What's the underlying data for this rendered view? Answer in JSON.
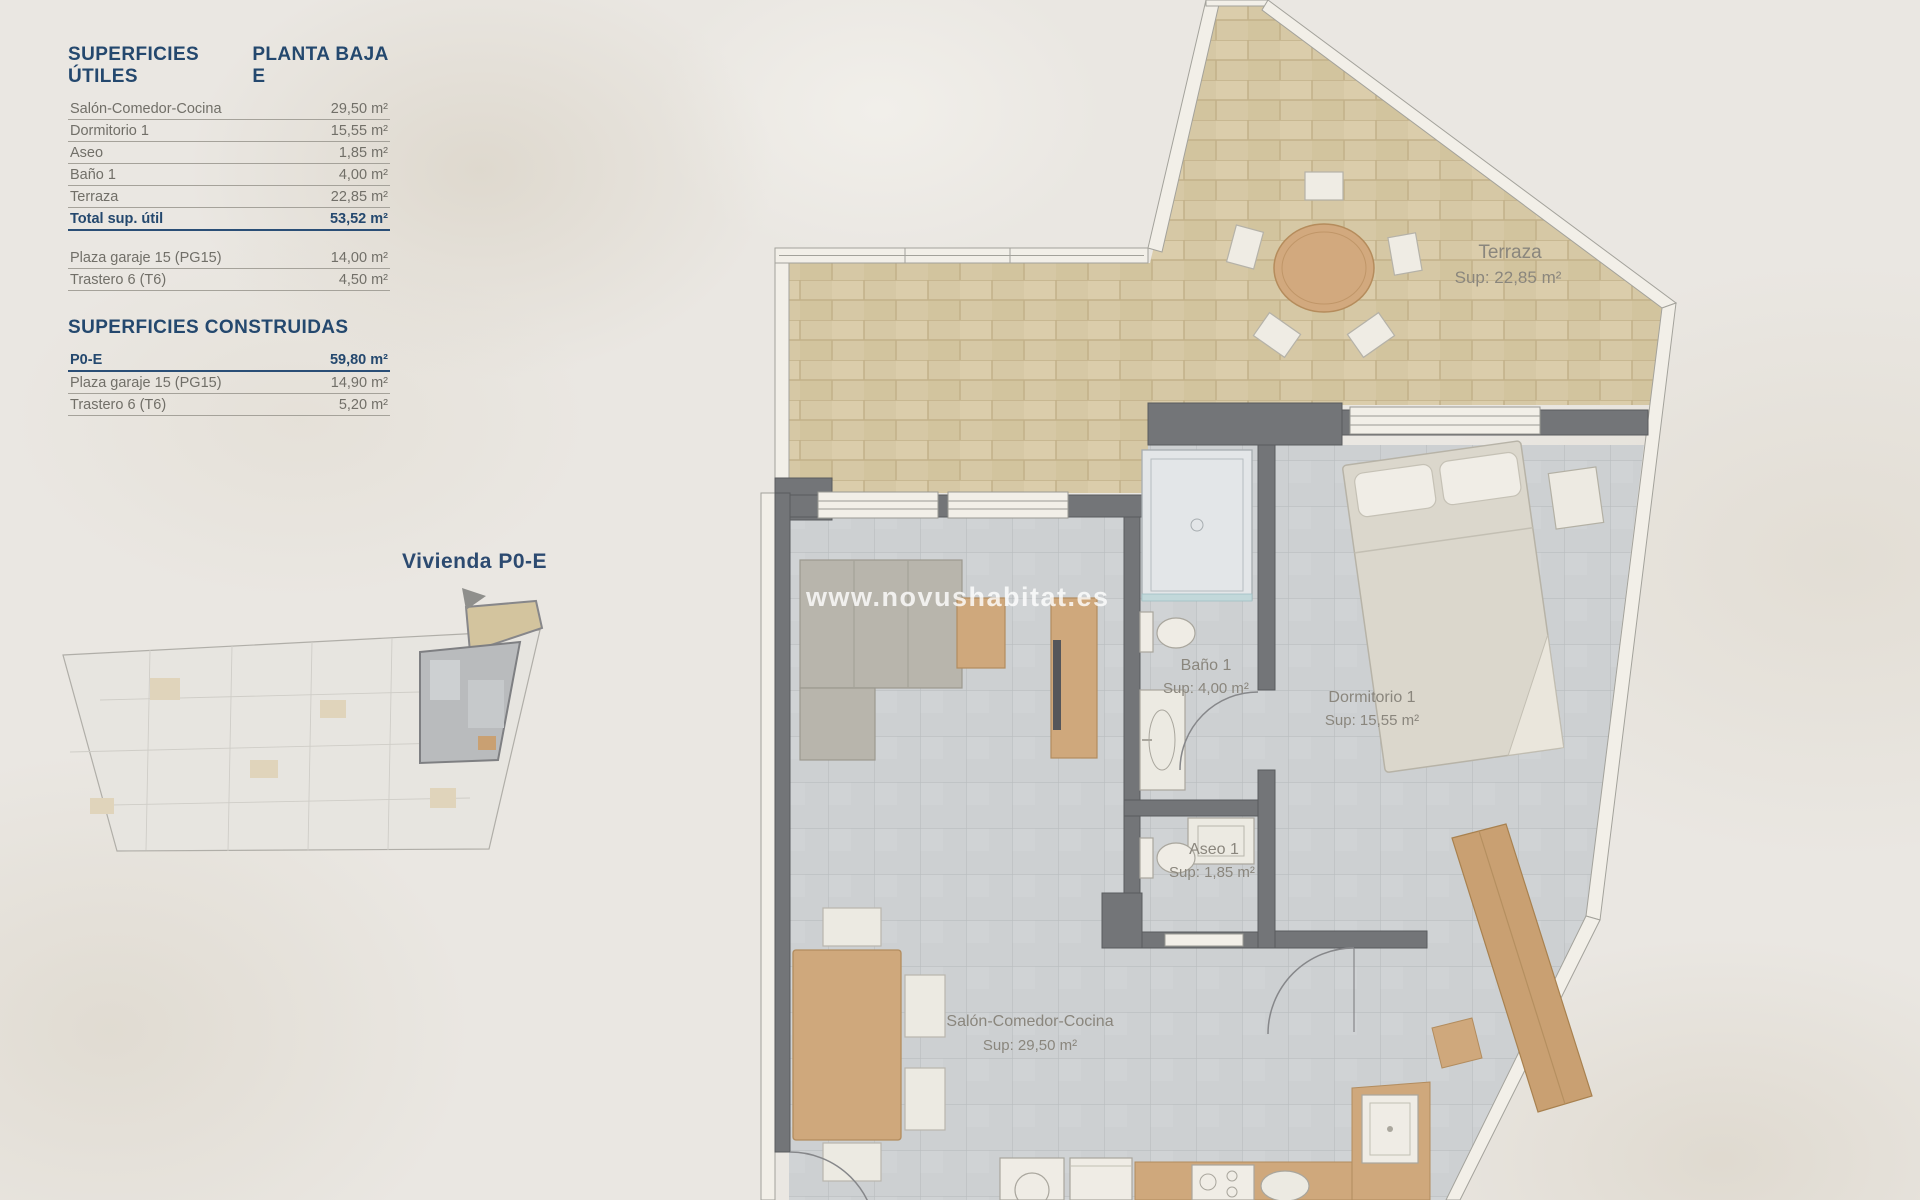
{
  "panel": {
    "utiles": {
      "title": "SUPERFICIES ÚTILES",
      "plan": "PLANTA BAJA E",
      "rows": [
        {
          "label": "Salón-Comedor-Cocina",
          "value": "29,50 m²"
        },
        {
          "label": "Dormitorio 1",
          "value": "15,55 m²"
        },
        {
          "label": "Aseo",
          "value": "1,85 m²"
        },
        {
          "label": "Baño 1",
          "value": "4,00 m²"
        },
        {
          "label": "Terraza",
          "value": "22,85 m²"
        }
      ],
      "total": {
        "label": "Total sup. útil",
        "value": "53,52 m²"
      },
      "extras": [
        {
          "label": "Plaza garaje 15 (PG15)",
          "value": "14,00 m²"
        },
        {
          "label": "Trastero 6 (T6)",
          "value": "4,50 m²"
        }
      ]
    },
    "construidas": {
      "title": "SUPERFICIES CONSTRUIDAS",
      "rows": [
        {
          "label": "P0-E",
          "value": "59,80 m²"
        },
        {
          "label": "Plaza garaje 15 (PG15)",
          "value": "14,90 m²"
        },
        {
          "label": "Trastero 6 (T6)",
          "value": "5,20 m²"
        }
      ]
    }
  },
  "keyplan": {
    "caption": "Vivienda P0-E"
  },
  "watermark": "www.novushabitat.es",
  "plan": {
    "rooms": {
      "terraza": {
        "name": "Terraza",
        "sup": "Sup: 22,85 m²"
      },
      "banio": {
        "name": "Baño 1",
        "sup": "Sup: 4,00 m²"
      },
      "dormitorio": {
        "name": "Dormitorio 1",
        "sup": "Sup: 15,55 m²"
      },
      "aseo": {
        "name": "Aseo 1",
        "sup": "Sup: 1,85 m²"
      },
      "salon": {
        "name": "Salón-Comedor-Cocina",
        "sup": "Sup: 29,50 m²"
      }
    }
  },
  "colors": {
    "accent_blue": "#2a4e76",
    "text_gray": "#716f68",
    "wall_gray": "#737578",
    "terrace_tile": "#d6c8a5",
    "floor_tile": "#cdd0d2",
    "wood": "#cfa87c"
  }
}
